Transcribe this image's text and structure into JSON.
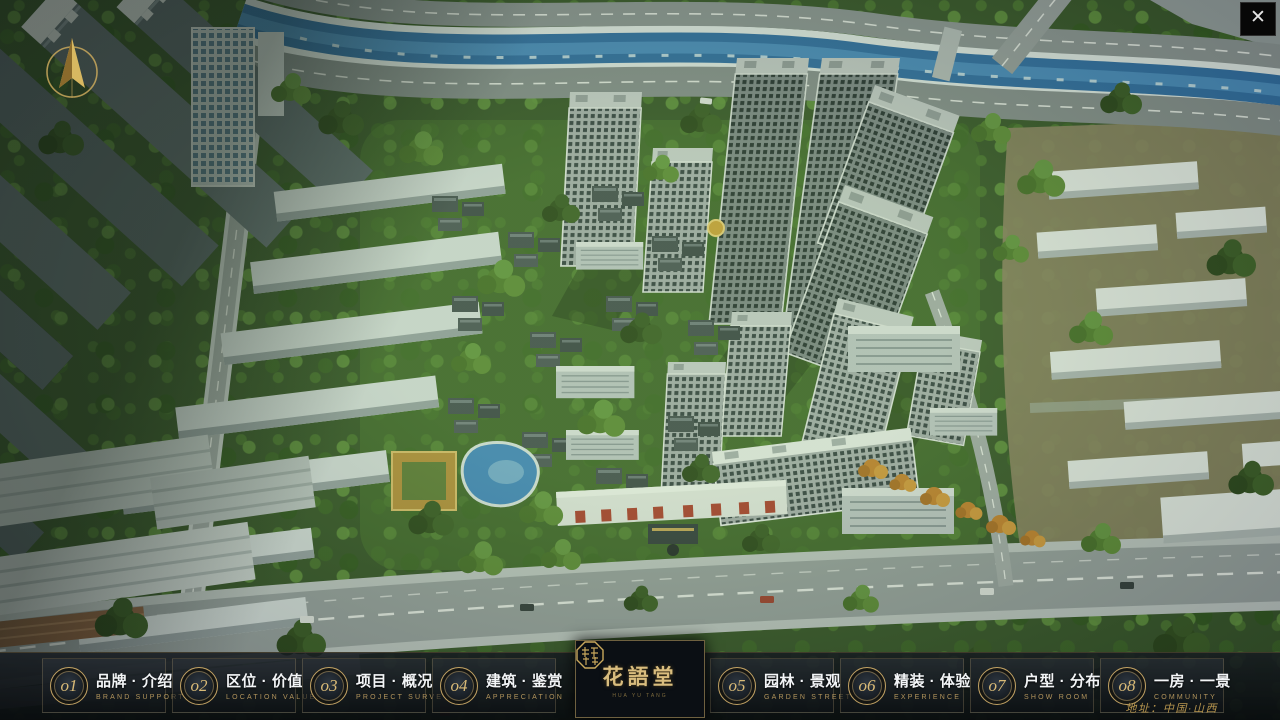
{
  "window": {
    "close": "✕"
  },
  "nav": {
    "items": [
      {
        "num": "o1",
        "zh": "品牌 · 介绍",
        "en": "BRAND SUPPORT"
      },
      {
        "num": "o2",
        "zh": "区位 · 价值",
        "en": "LOCATION VALUE"
      },
      {
        "num": "o3",
        "zh": "项目 · 概况",
        "en": "PROJECT SURVEY"
      },
      {
        "num": "o4",
        "zh": "建筑 · 鉴赏",
        "en": "APPRECIATION"
      },
      {
        "num": "o5",
        "zh": "园林 · 景观",
        "en": "GARDEN STREET"
      },
      {
        "num": "o6",
        "zh": "精装 · 体验",
        "en": "EXPERIENCE"
      },
      {
        "num": "o7",
        "zh": "户型 · 分布",
        "en": "SHOW ROOM"
      },
      {
        "num": "o8",
        "zh": "一房 · 一景",
        "en": "COMMUNITY"
      }
    ]
  },
  "logo": {
    "title": "花語堂",
    "subtitle": "HUA YU TANG"
  },
  "footer": {
    "address": "地址：中国·山西"
  },
  "colors": {
    "accent_gold": "#c8a35f",
    "bar_bg": "#10141a",
    "river_blue": "#2d6cac"
  }
}
